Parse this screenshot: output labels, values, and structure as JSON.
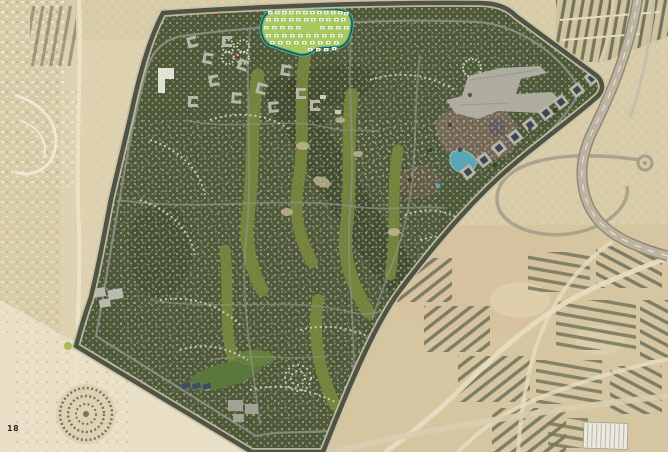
{
  "page": {
    "number": "18"
  },
  "map": {
    "description": "Aerial satellite masterplan of a golf-course residential community surrounded by desert, with one parcel highlighted in bright green at the top",
    "colors": {
      "desert_base": "#d8cba7",
      "desert_light": "#e7dcbd",
      "desert_pink": "#d9bfa0",
      "development_green": "#4e5939",
      "development_dark": "#3c452c",
      "fairway_green": "#79883f",
      "lawn_green": "#5c773a",
      "highlight_fill": "#a9cb5e",
      "highlight_border": "#1d5b49",
      "building_white": "#f2f2e6",
      "building_gray": "#b5b6a9",
      "road_gray": "#90938a",
      "boundary_dark": "#4e5445",
      "boundary_light": "#cbc2a6",
      "outside_road": "#e7dcc0",
      "water_blue": "#58aabb",
      "court_blue": "#3f4f5a",
      "rowhouse_dark": "#6e7158",
      "earth_brown": "#7b695a",
      "page_number_color": "#2f2f2a"
    },
    "features": [
      "masterplan-development",
      "golf-fairways",
      "highlighted-parcel",
      "perimeter-boundary-road",
      "shopping-complex",
      "pavilion-square-buildings",
      "lagoon",
      "sports-club",
      "apartment-blocks",
      "desert-terrain",
      "existing-neighborhoods-west",
      "construction-rows-southeast",
      "loop-road",
      "roundabout",
      "highway-east",
      "warehouse",
      "ring-community",
      "page-number"
    ]
  }
}
